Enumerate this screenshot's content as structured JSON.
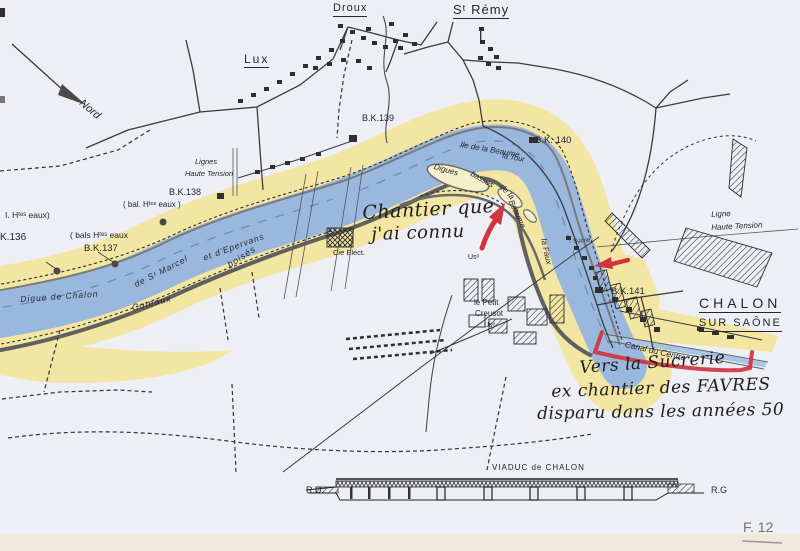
{
  "figure": {
    "number": "F. 12"
  },
  "colors": {
    "river_blue": "#9ab7de",
    "bank_yellow": "#f2e6a2",
    "annotation_red": "#cf3440",
    "ink_black": "#2b2b2e"
  },
  "towns": {
    "droux": "Droux",
    "lux": "Lux",
    "st_remy": "Sᵗ Rémy",
    "chalon_line1": "CHALON",
    "chalon_line2": "SUR SAÔNE"
  },
  "compass": {
    "north": "Nord"
  },
  "km_markers": {
    "bk136": "K.136",
    "bk137": "B.K.137",
    "bk138": "B.K.138",
    "bk139": "B.K.139",
    "bk140": "B.K. 140",
    "bk141": "B.K.141"
  },
  "water_level_notes": {
    "note1": "I. Hᵗᵉˢ eaux)",
    "note2": "( bals Hᵗᵉˢ eaux",
    "note3": "( bal. Hᵗᵉˢ eaux )"
  },
  "power_lines": {
    "left_line1": "Lignes",
    "left_line2": "Haute Tension",
    "right_line1": "Ligne",
    "right_line2": "Haute Tension"
  },
  "river_features": {
    "island": "Ile de la Beaume",
    "tower": "la Tour",
    "digues_seg1": "Digues",
    "digues_seg2": "basses",
    "digues_seg3": "de la",
    "digues_seg4": "Beaume",
    "channel": "la Faux",
    "digue_seg1": "Digue de Chalon",
    "digue_seg2": "de Sᵗ Marcel",
    "digue_seg3": "et d'Epervans",
    "hills_seg1": "Coteaux",
    "hills_seg2": "boisés",
    "canal": "Canal du Centre"
  },
  "industry": {
    "electric_co": "Cie Elect.",
    "factory_abbr": "Usᵉ",
    "creusot_line1": "le Petit",
    "creusot_line2": "Creusot",
    "creusot_line3": "Usᵉ",
    "sugar_refinery_small": "Sucrie"
  },
  "viaduct": {
    "title": "VIADUC de CHALON",
    "left_bank": "R.D.",
    "right_bank": "R.G"
  },
  "handwritten": {
    "note1_line1": "Chantier que",
    "note1_line2": "j'ai connu",
    "note2_line1": "Vers la Sucrerie",
    "note2_line2": "ex chantier des FAVRES",
    "note2_line3": "disparu dans les années 50"
  }
}
